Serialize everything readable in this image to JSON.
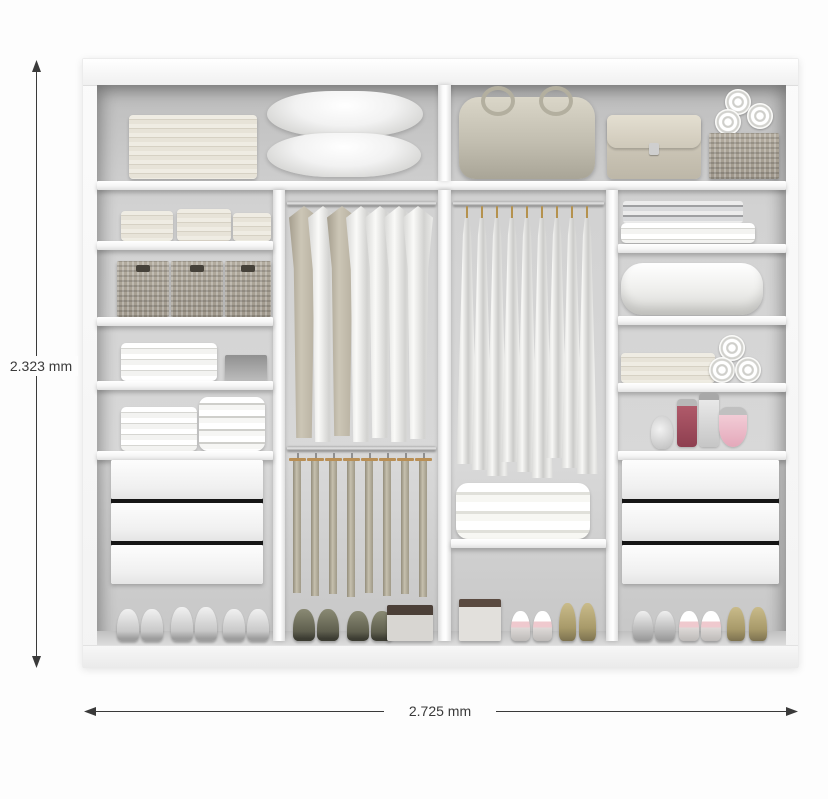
{
  "annotations": {
    "height_label": "2.323 mm",
    "width_label": "2.725 mm",
    "line_color": "#3a3a3a"
  },
  "wardrobe": {
    "frame_color": "#f7f7f7",
    "interior_color": "#d2d2d2",
    "drawer_gap_color": "#161616",
    "sections": {
      "top_left": [
        "stack of folded towels",
        "stack of pillows"
      ],
      "top_right": [
        "travel bag",
        "handbag",
        "wicker box with three rolled towels"
      ],
      "left_column": [
        "three stacks of folded towels",
        "three wicker baskets",
        "folded linens and gray box",
        "two stacks of folded garments",
        "three drawers",
        "three pairs of sneakers"
      ],
      "center_left_column": [
        "rod with seven hanging shirts",
        "rod with eight hanging trousers",
        "two pairs of sneakers and storage box"
      ],
      "center_right_column": [
        "rod with nine hanging dresses",
        "folded blanket on shelf",
        "storage box, ballet flats and heeled shoes"
      ],
      "right_column": [
        "folded sheets",
        "folded duvet",
        "folded towels and three towel rolls",
        "four perfume bottles",
        "three drawers",
        "three pairs of dress shoes"
      ]
    }
  }
}
